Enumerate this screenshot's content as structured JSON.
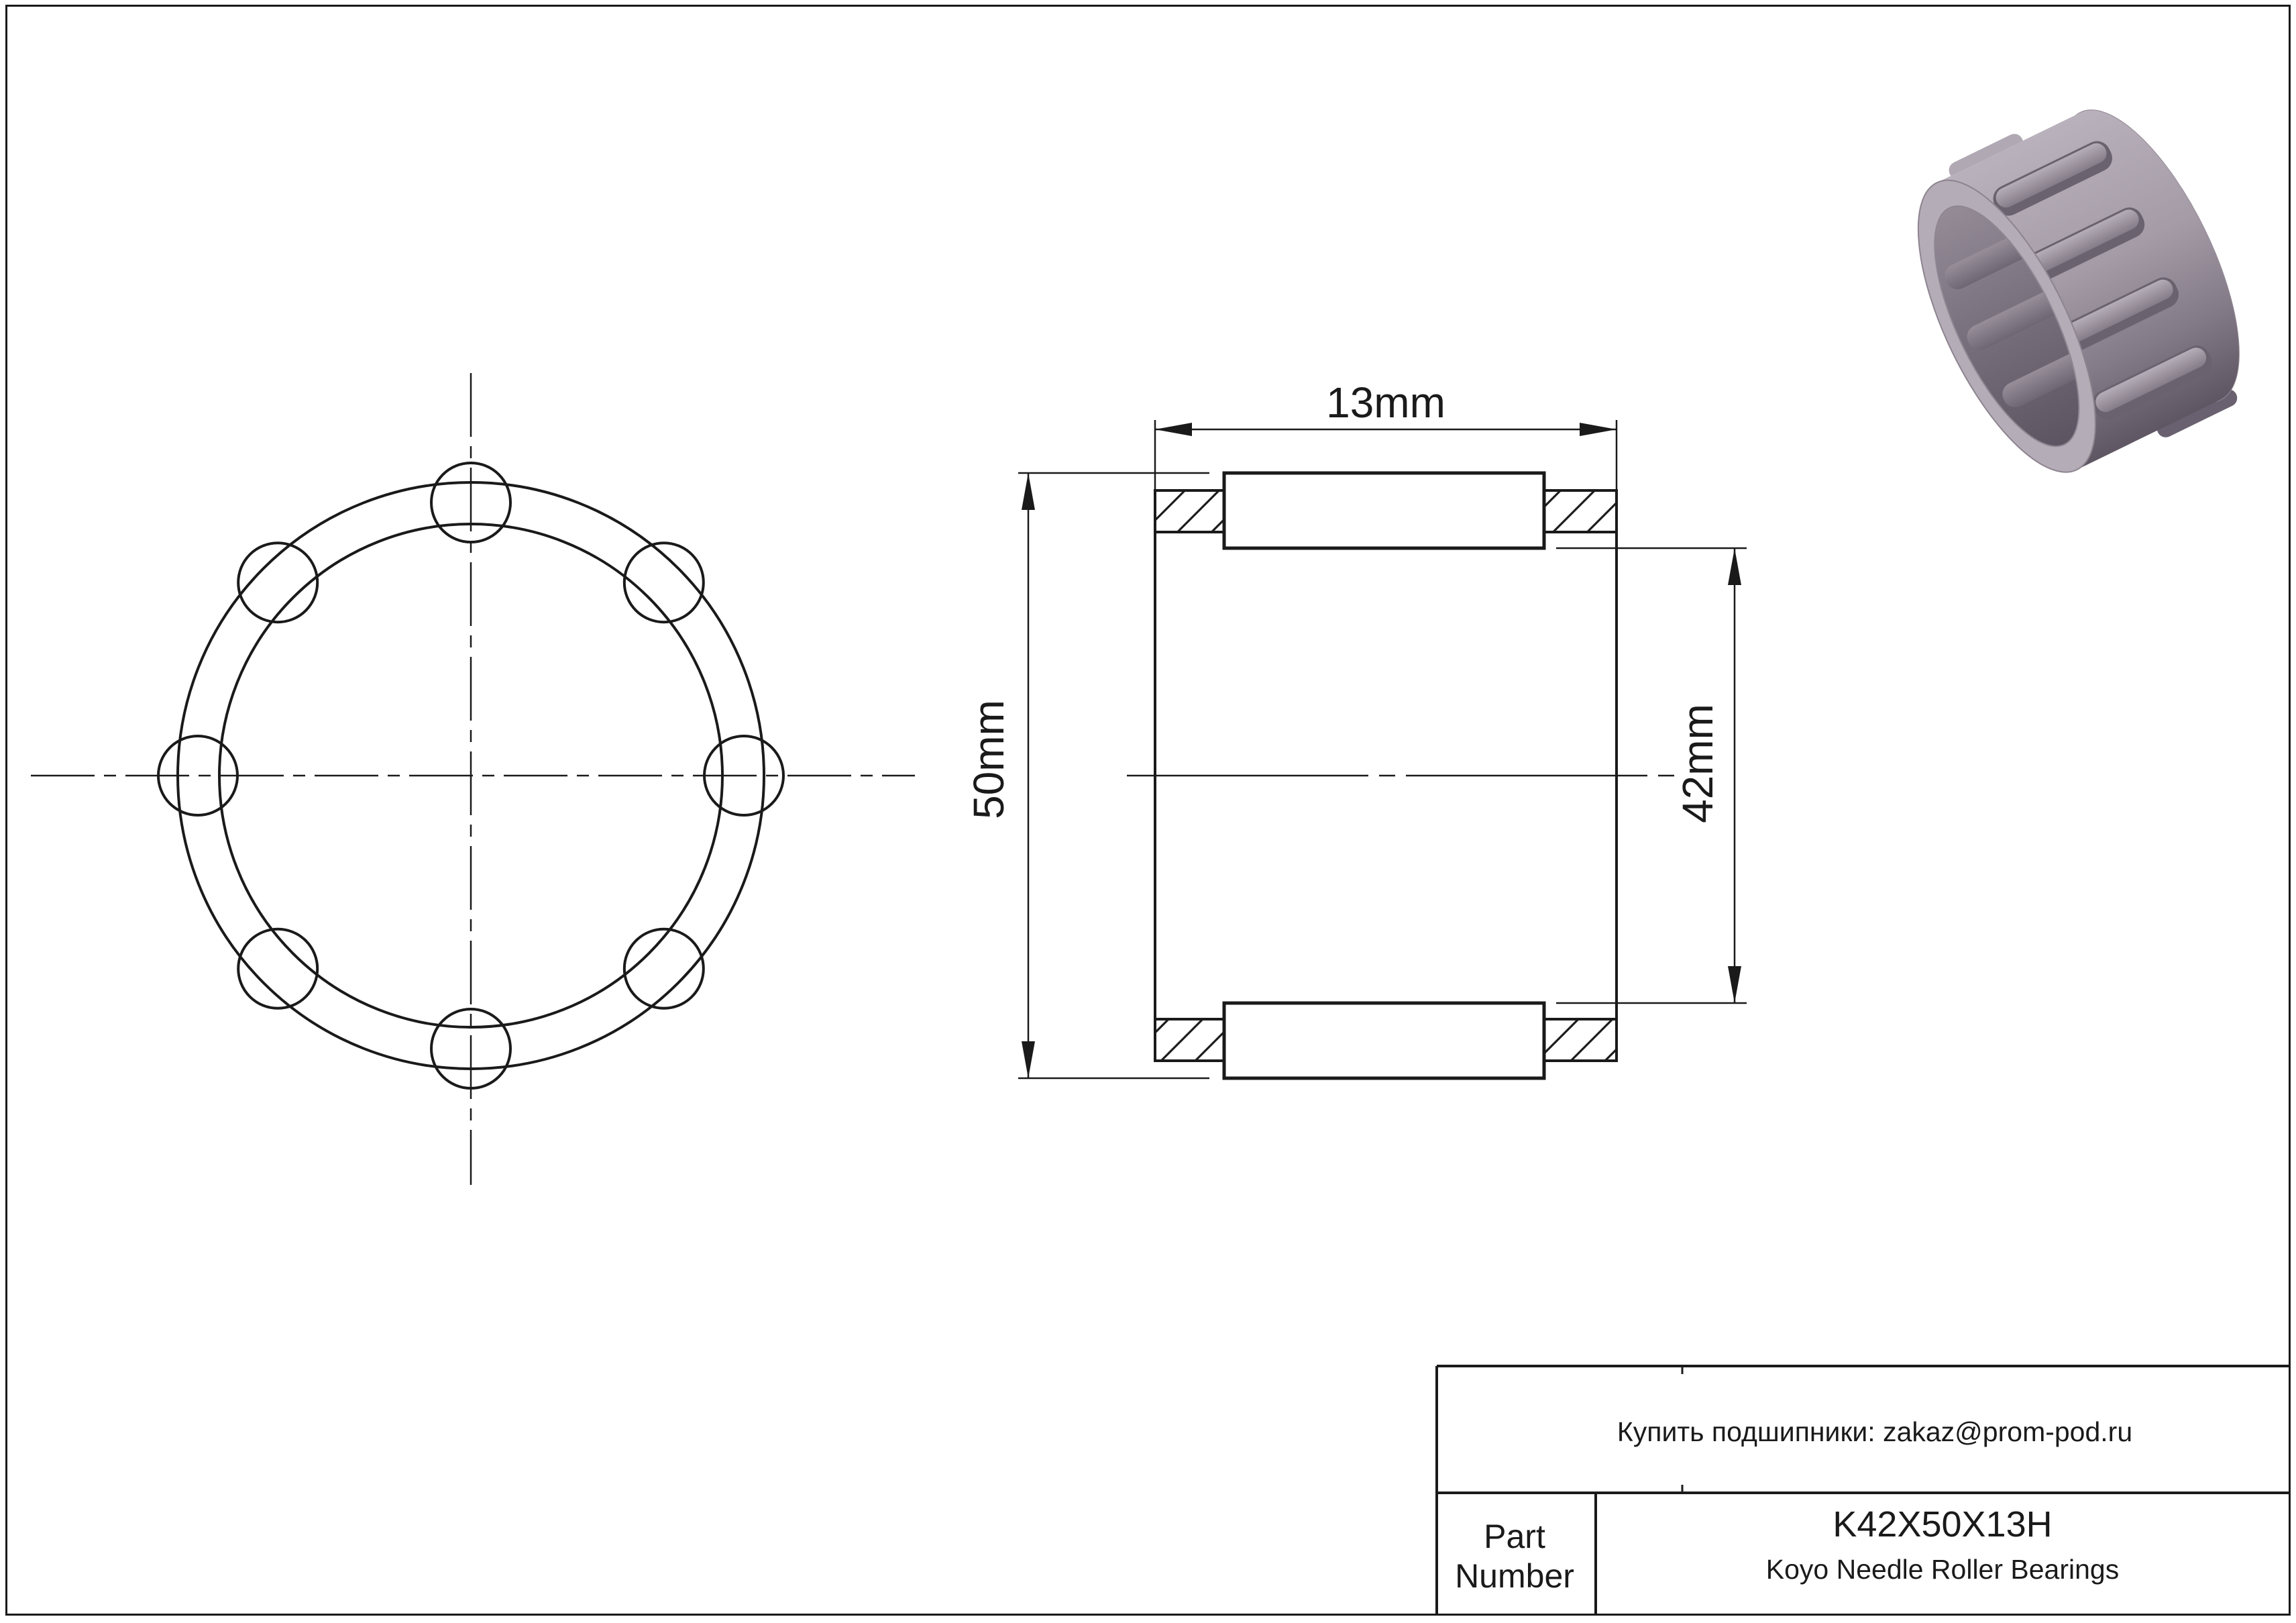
{
  "page": {
    "background": "#ffffff",
    "line_color": "#1a1a1a"
  },
  "dimensions": {
    "width_label": "13mm",
    "outer_diameter_label": "50mm",
    "inner_diameter_label": "42mm"
  },
  "title_block": {
    "contact_line": "Купить подшипники: zakaz@prom-pod.ru",
    "part_label_line1": "Part",
    "part_label_line2": "Number",
    "part_number": "K42X50X13H",
    "product_line": "Koyo Needle Roller Bearings"
  },
  "render_colors": {
    "shell_light": "#b9b1bb",
    "shell_mid": "#9a919d",
    "shell_dark": "#5f5663",
    "bore_top": "#948b97",
    "bore_bottom": "#5d5462",
    "roller_light": "#b5adb7",
    "roller_dark": "#857c89"
  }
}
